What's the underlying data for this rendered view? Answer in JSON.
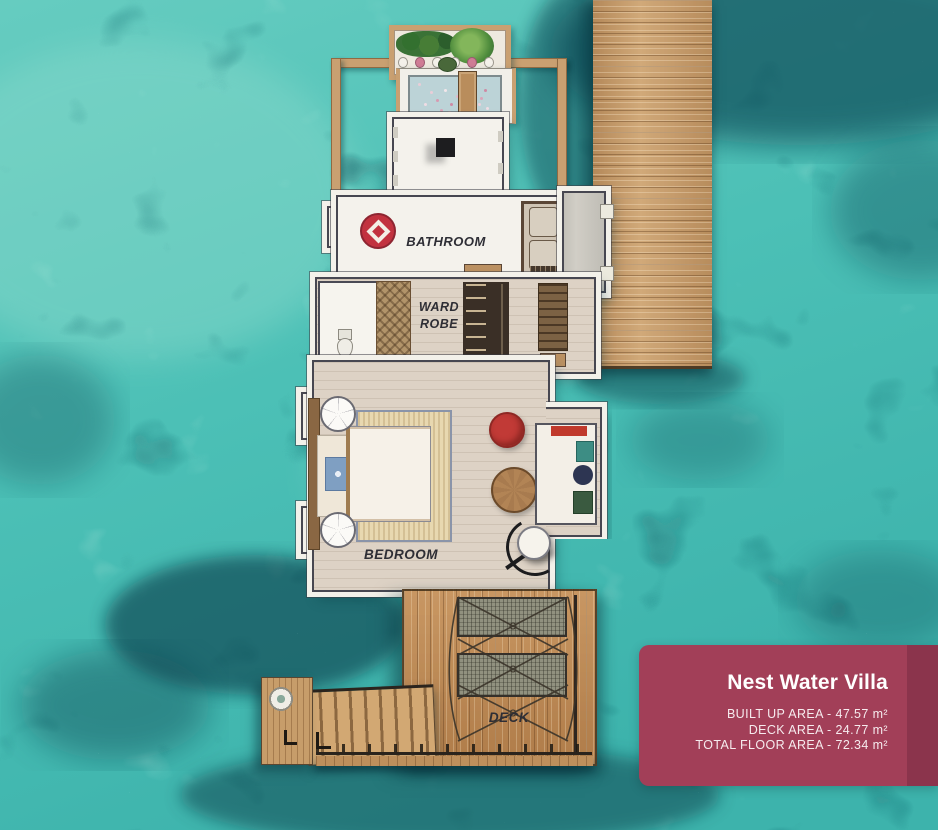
{
  "plan": {
    "labels": {
      "bathroom": "BATHROOM",
      "wardrobe_line1": "WARD",
      "wardrobe_line2": "ROBE",
      "bedroom": "BEDROOM",
      "deck": "DECK"
    }
  },
  "card": {
    "title": "Nest Water Villa",
    "lines": [
      "BUILT UP AREA - 47.57 m²",
      "DECK AREA - 24.77 m²",
      "TOTAL FLOOR AREA - 72.34 m²"
    ]
  },
  "colors": {
    "ocean_base": "#4fc4ba",
    "ocean_dark_coral": "#14555e",
    "ocean_light_sand": "#a9e4d8",
    "jetty_wood": "#c99e6c",
    "deck_wood": "#c08b55",
    "wall_white": "#f3f1ea",
    "wall_outline": "#474751",
    "floor": "#ddd2c5",
    "label_text": "#2e2e35",
    "card_background": "#a23f58",
    "card_edge": "#8c3148",
    "card_text": "#ffffff",
    "accent_red": "#c13a36",
    "rug_border": "#8a94a9",
    "rug_fill": "#e8d8b0",
    "tub_water": "#bcd3d7"
  }
}
